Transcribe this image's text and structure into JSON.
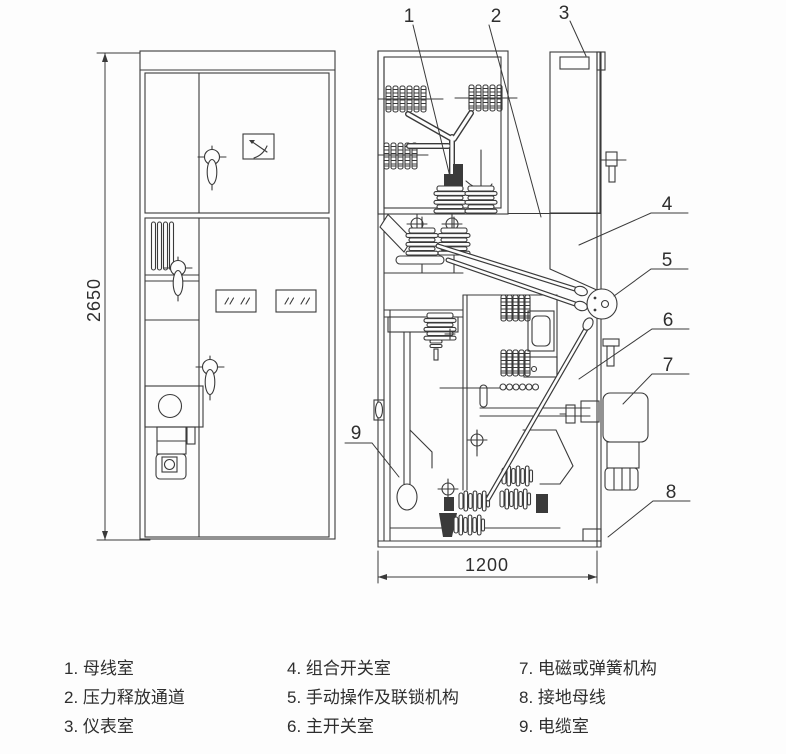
{
  "colors": {
    "line": "#3a3a3a",
    "text": "#2e2e2e",
    "bg": "#fdfdfd"
  },
  "dimensions": {
    "height": "2650",
    "width": "1200"
  },
  "callouts": [
    {
      "num": "1",
      "label": "母线室"
    },
    {
      "num": "2",
      "label": "压力释放通道"
    },
    {
      "num": "3",
      "label": "仪表室"
    },
    {
      "num": "4",
      "label": "组合开关室"
    },
    {
      "num": "5",
      "label": "手动操作及联锁机构"
    },
    {
      "num": "6",
      "label": "主开关室"
    },
    {
      "num": "7",
      "label": "电磁或弹簧机构"
    },
    {
      "num": "8",
      "label": "接地母线"
    },
    {
      "num": "9",
      "label": "电缆室"
    }
  ],
  "legend": {
    "items": [
      {
        "label": "1. 母线室"
      },
      {
        "label": "2. 压力释放通道"
      },
      {
        "label": "3. 仪表室"
      },
      {
        "label": "4. 组合开关室"
      },
      {
        "label": "5. 手动操作及联锁机构"
      },
      {
        "label": "6. 主开关室"
      },
      {
        "label": "7. 电磁或弹簧机构"
      },
      {
        "label": "8. 接地母线"
      },
      {
        "label": "9. 电缆室"
      }
    ]
  }
}
